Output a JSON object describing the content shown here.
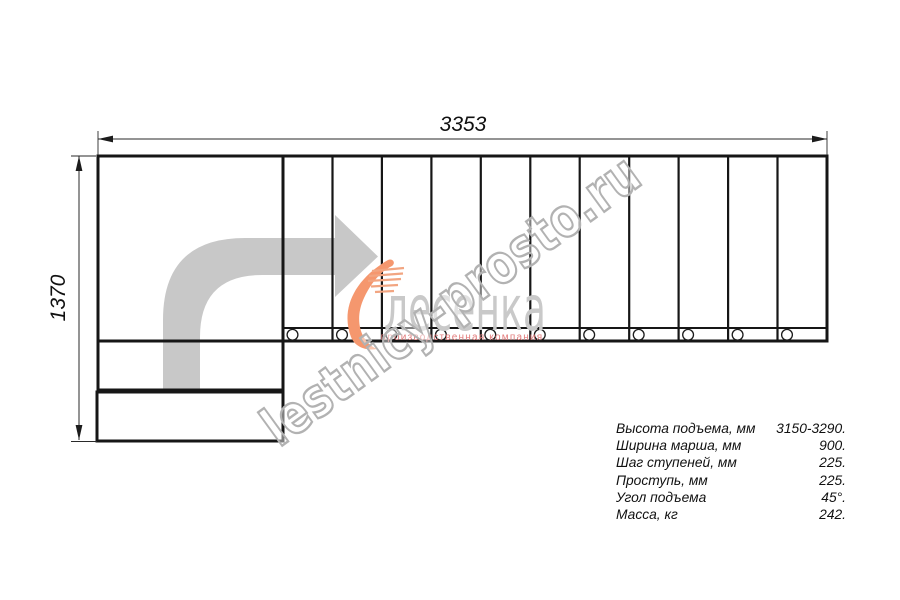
{
  "dimensions": {
    "total_length_mm": "3353",
    "total_width_mm": "1370"
  },
  "spec_table": {
    "rows": [
      {
        "label": "Высота подъема, мм",
        "value": "3150-3290."
      },
      {
        "label": "Ширина марша, мм",
        "value": "900."
      },
      {
        "label": "Шаг ступеней, мм",
        "value": "225."
      },
      {
        "label": "Проступь, мм",
        "value": "225."
      },
      {
        "label": "Угол подъема",
        "value": "45°."
      },
      {
        "label": "Масса, кг",
        "value": "242."
      }
    ]
  },
  "watermark": {
    "site": "lestnicy-prosto.ru",
    "logo_name": "лесенка",
    "logo_subtitle": "производственная компания"
  },
  "drawing": {
    "flight_steps": 11,
    "bolt_holes": 11,
    "lower_steps": 2,
    "colors": {
      "line": "#161616",
      "direction_arrow": "#c8c8c8",
      "watermark_outline": "#b2b2b2",
      "logo_gray": "#c9c9c9",
      "logo_red": "#e27d7d",
      "logo_orange": "#f4a17c"
    }
  }
}
